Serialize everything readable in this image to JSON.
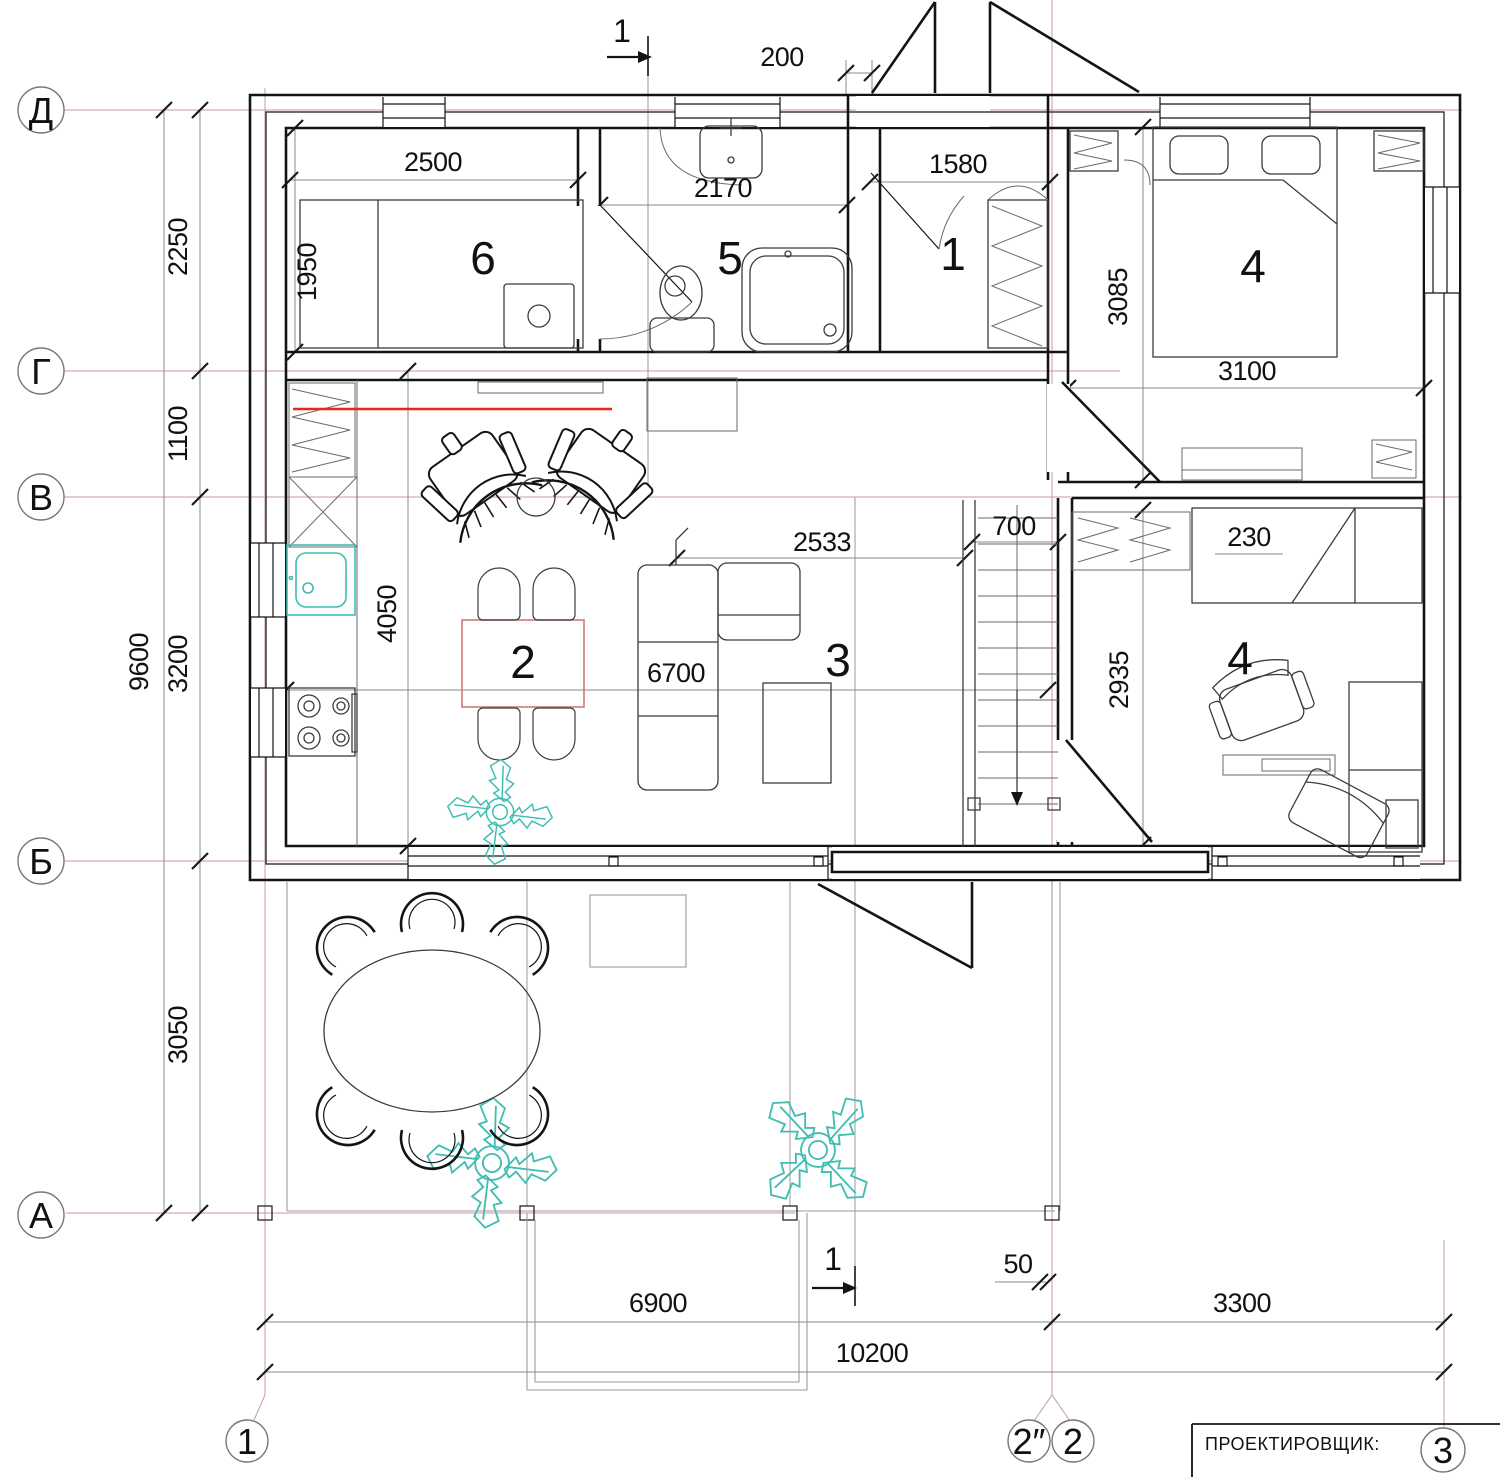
{
  "title_block": {
    "label": "ПРОЕКТИРОВЩИК:"
  },
  "axes": {
    "horizontal": [
      {
        "id": "D",
        "label": "Д"
      },
      {
        "id": "G",
        "label": "Г"
      },
      {
        "id": "V",
        "label": "В"
      },
      {
        "id": "B",
        "label": "Б"
      },
      {
        "id": "A",
        "label": "А"
      }
    ],
    "vertical": [
      {
        "id": "1",
        "label": "1"
      },
      {
        "id": "2s",
        "label": "2″"
      },
      {
        "id": "2",
        "label": "2"
      },
      {
        "id": "3",
        "label": "3"
      }
    ]
  },
  "rooms": {
    "r6": "6",
    "r5": "5",
    "r1": "1",
    "r4a": "4",
    "r2": "2",
    "r3": "3",
    "r4b": "4"
  },
  "dimensions": {
    "d200": "200",
    "d2500": "2500",
    "d2170": "2170",
    "d1580": "1580",
    "d1950": "1950",
    "d2250": "2250",
    "d1100": "1100",
    "d9600": "9600",
    "d3200": "3200",
    "d3050": "3050",
    "d3085": "3085",
    "d3100": "3100",
    "d2533": "2533",
    "d700": "700",
    "d230": "230",
    "d2935": "2935",
    "d4050": "4050",
    "d6700": "6700",
    "d6900": "6900",
    "d50": "50",
    "d3300": "3300",
    "d10200": "10200"
  },
  "section_marks": {
    "top": "1",
    "bottom": "1"
  },
  "colors": {
    "axis_line": "#c59c9c",
    "highlight_red": "#e8281e",
    "fixture_teal": "#3fbdb3",
    "table_pink": "#cc7a7a",
    "wall": "#141414"
  }
}
